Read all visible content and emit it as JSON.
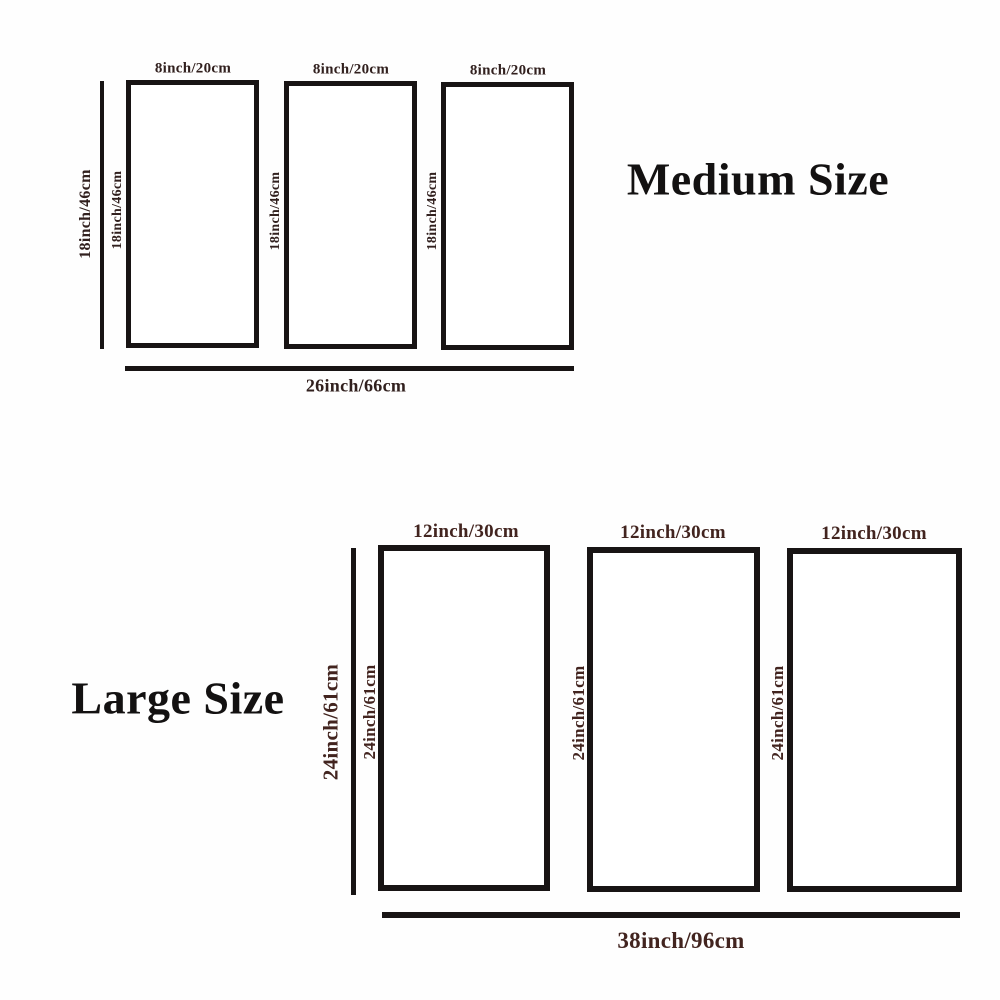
{
  "diagram": {
    "type": "product-size-diagram",
    "background_color": "#fefefe",
    "line_color": "#181414",
    "medium_label_color": "#31201e",
    "large_label_color": "#42241f",
    "title_color": "#131111"
  },
  "medium": {
    "title": "Medium Size",
    "overall_height_label": "18inch/46cm",
    "overall_width_label": "26inch/66cm",
    "panels": [
      {
        "top_label": "8inch/20cm",
        "side_label": "18inch/46cm"
      },
      {
        "top_label": "8inch/20cm",
        "side_label": "18inch/46cm"
      },
      {
        "top_label": "8inch/20cm",
        "side_label": "18inch/46cm"
      }
    ]
  },
  "large": {
    "title": "Large Size",
    "overall_height_label": "24inch/61cm",
    "overall_width_label": "38inch/96cm",
    "panels": [
      {
        "top_label": "12inch/30cm",
        "side_label": "24inch/61cm"
      },
      {
        "top_label": "12inch/30cm",
        "side_label": "24inch/61cm"
      },
      {
        "top_label": "12inch/30cm",
        "side_label": "24inch/61cm"
      }
    ]
  }
}
